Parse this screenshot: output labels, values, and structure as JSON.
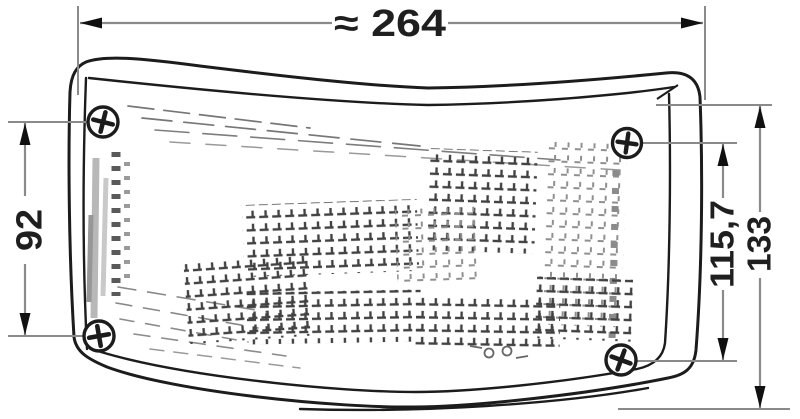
{
  "page": {
    "background": "#ffffff"
  },
  "drawing": {
    "dimensions": {
      "overall_width": "≈ 264",
      "left_fixing_height": "92",
      "right_fixing_height": "115,7",
      "overall_height": "133"
    },
    "screws": {
      "count": "4"
    },
    "colors": {
      "background": "#ffffff",
      "outline": "#1c1c1c",
      "dim_line": "#8a8a8a",
      "arrow": "#101010",
      "label": "#1f1f1f",
      "hatch": "#424242",
      "hatch_light": "#8f8f8f",
      "shade": "#b8b8b8"
    }
  }
}
